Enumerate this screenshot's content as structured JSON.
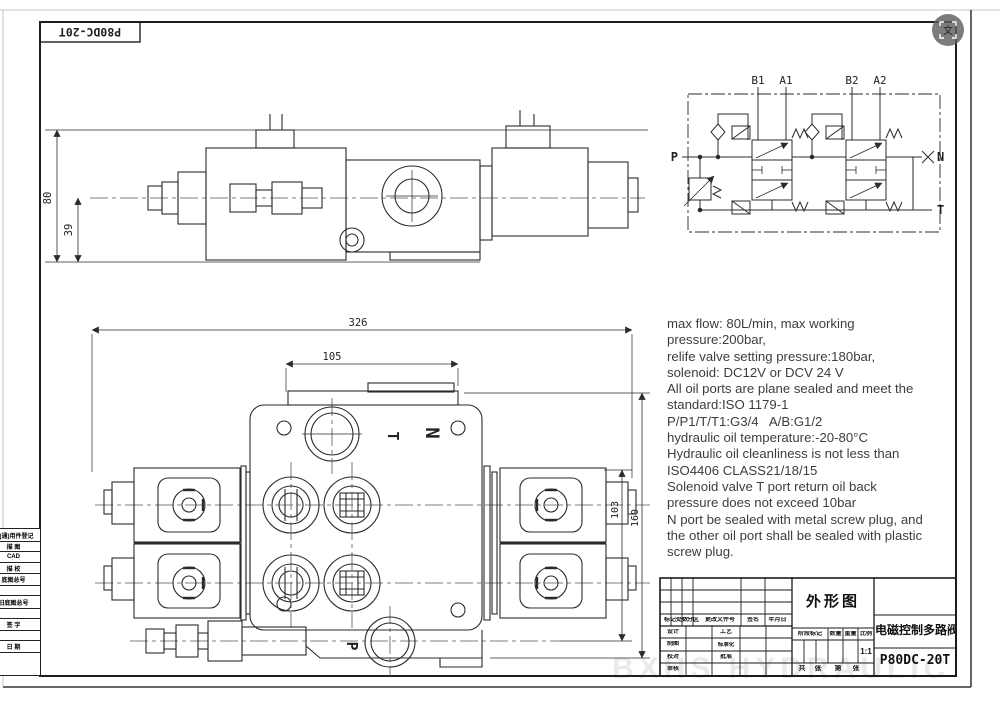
{
  "viewer": {
    "translate_glyph": "文"
  },
  "sheet": {
    "corner_model": "P80DC-20T",
    "watermark": "BXHS HYDRAULIC"
  },
  "schematic": {
    "b1": "B1",
    "a1": "A1",
    "b2": "B2",
    "a2": "A2",
    "p": "P",
    "n": "N",
    "t": "T"
  },
  "side_view": {
    "dim_total_height": "80",
    "dim_lower_height": "39"
  },
  "front_view": {
    "dim_total_width": "326",
    "dim_top_width": "105",
    "dim_inner_height": "103",
    "dim_total_height": "160",
    "port_t": "T",
    "port_n": "N",
    "port_p": "P"
  },
  "specs": {
    "lines": [
      "max flow: 80L/min, max working",
      "pressure:200bar,",
      "relife valve setting pressure:180bar,",
      "solenoid: DC12V or DCV 24 V",
      "All oil ports are plane sealed and meet the",
      "standard:ISO 1179-1",
      "P/P1/T/T1:G3/4   A/B:G1/2",
      "hydraulic oil temperature:-20-80°C",
      "Hydraulic oil cleanliness is not less than",
      "ISO4406 CLASS21/18/15",
      "Solenoid valve T port return oil back",
      "pressure does not exceed 10bar",
      "N port be sealed with metal screw plug, and",
      "the other oil port shall be sealed with plastic",
      "screw plug."
    ]
  },
  "title_block": {
    "drawing_title": "外形图",
    "product_name": "电磁控制多路阀",
    "model": "P80DC-20T",
    "scale_value": "1:1",
    "revision_header": {
      "mark_count": "标记处数",
      "zone": "分区",
      "change_file_no": "更改文件号",
      "signature": "签名",
      "date": "年月日"
    },
    "roles": {
      "design": "设计",
      "process": "工艺",
      "draft": "制图",
      "standardization": "标准化",
      "check": "校对",
      "approve": "批准",
      "review": "审核"
    },
    "stage_header": {
      "stage_mark": "阶段标记",
      "quantity": "数量",
      "weight": "重量",
      "scale": "比例"
    },
    "sheet_info": {
      "total_label": "共",
      "total_unit": "张",
      "page_label": "第",
      "page_unit": "张"
    }
  },
  "margin_block": {
    "rows": [
      "借(通)用件登记",
      "描 图",
      "CAD",
      "描 校",
      "底图总号",
      "",
      "旧底图总号",
      "",
      "签 字",
      "",
      "日 期",
      ""
    ]
  }
}
